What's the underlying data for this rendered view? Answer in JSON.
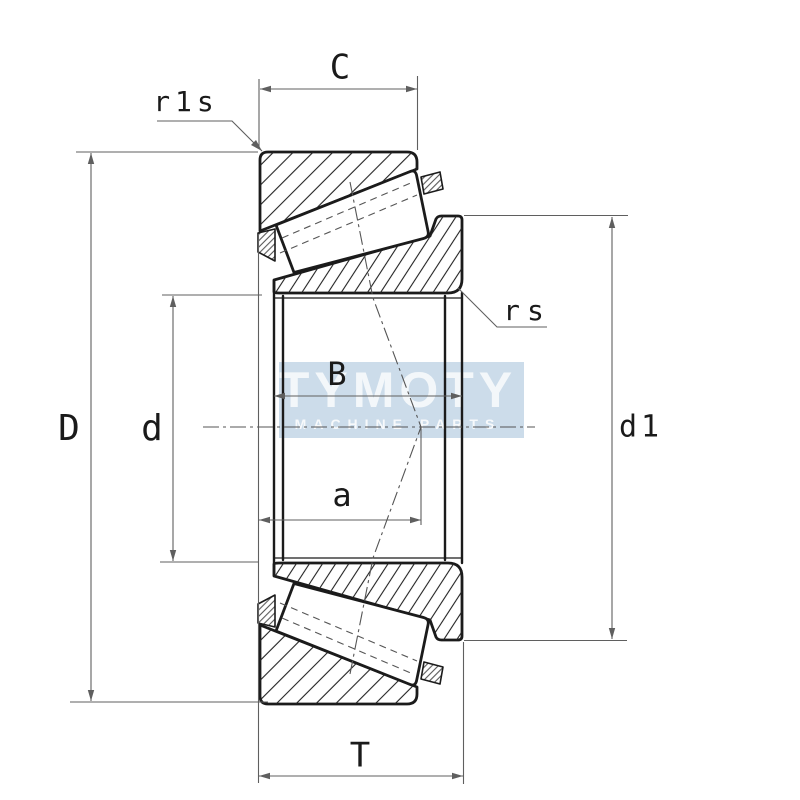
{
  "page": {
    "type": "technical-drawing",
    "subject": "tapered roller bearing cross-section",
    "background": "#ffffff"
  },
  "labels": {
    "cup_width": "C",
    "cup_corner_radius": "r1s",
    "cone_corner_radius": "rs",
    "outer_diameter": "D",
    "bore_diameter": "d",
    "cone_width": "B",
    "load_center_distance": "a",
    "rib_diameter": "d1",
    "total_width": "T"
  },
  "watermark": {
    "brand": "TYMOTY",
    "tagline": "MACHINE PARTS",
    "band_color": "#c8d9e8",
    "letter_color": "#ffffff"
  },
  "style": {
    "object_line_color": "#1b1b1b",
    "dimension_line_color": "#5f5f5f",
    "label_color": "#1a1a1a",
    "hatch_color": "#222222"
  }
}
